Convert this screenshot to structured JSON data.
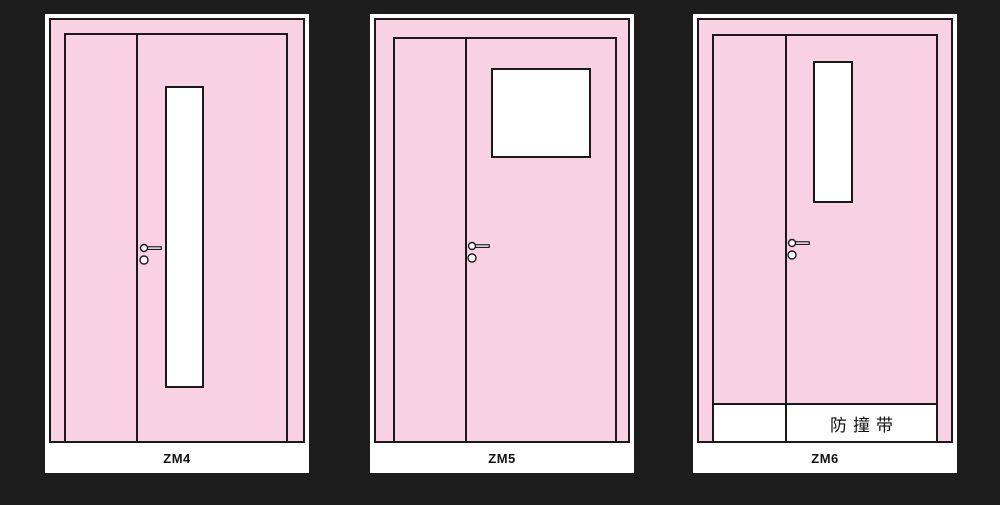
{
  "colors": {
    "background": "#1d1d1d",
    "door_pink": "#f8d2e2",
    "outline": "#1a1a1a",
    "panel_white": "#ffffff"
  },
  "panels": [
    {
      "label": "ZM4"
    },
    {
      "label": "ZM5"
    },
    {
      "label": "ZM6",
      "band_label": "防撞带"
    }
  ]
}
